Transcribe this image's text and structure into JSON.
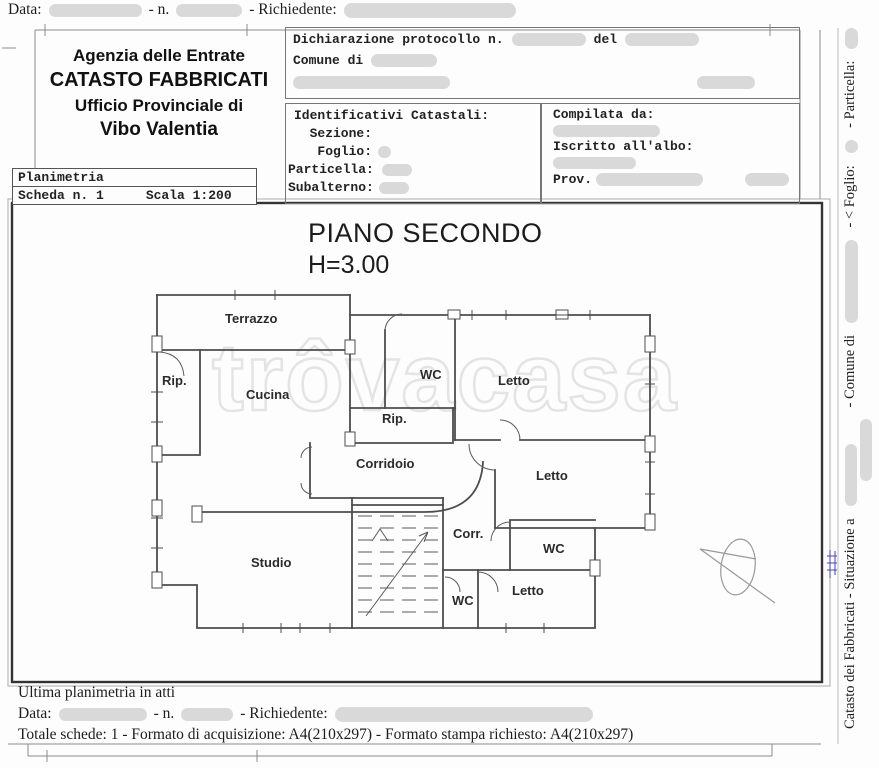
{
  "topline": {
    "data_label": "Data:",
    "n_label": "- n.",
    "richiedente_label": "- Richiedente:"
  },
  "agency": {
    "line1": "Agenzia delle Entrate",
    "line2": "CATASTO FABBRICATI",
    "line3": "Ufficio Provinciale di",
    "line4": "Vibo Valentia"
  },
  "declaration": {
    "protocol_label": "Dichiarazione protocollo n.",
    "del_label": "del",
    "comune_label": "Comune di"
  },
  "identificativi": {
    "title": "Identificativi Catastali:",
    "sezione": "  Sezione:",
    "foglio": "   Foglio:",
    "particella": "Particella:",
    "subalterno": "Subalterno:"
  },
  "compilata": {
    "title": "Compilata da:",
    "iscritto": "Iscritto all'albo:",
    "prov": "Prov."
  },
  "planimetria": {
    "title": "Planimetria",
    "scheda": "Scheda n. 1",
    "scala": "Scala 1:200"
  },
  "plan": {
    "title": "PIANO SECONDO",
    "height_label": "H=3.00",
    "watermark": "trôvacasa",
    "rooms": [
      {
        "label": "Terrazzo"
      },
      {
        "label": "Rip."
      },
      {
        "label": "Cucina"
      },
      {
        "label": "WC"
      },
      {
        "label": "Letto"
      },
      {
        "label": "Rip."
      },
      {
        "label": "Corridoio"
      },
      {
        "label": "Letto"
      },
      {
        "label": "Corr."
      },
      {
        "label": "WC"
      },
      {
        "label": "Studio"
      },
      {
        "label": "WC"
      },
      {
        "label": "Letto"
      }
    ]
  },
  "side_strip": {
    "part1": "Catasto dei Fabbricati - Situazione a",
    "part2": "- Comune di",
    "part3": "- < Foglio:",
    "part4": "- Particella:"
  },
  "footer": {
    "ultima": "Ultima planimetria in atti",
    "data_label": "Data:",
    "n_label": "- n.",
    "richiedente_label": "- Richiedente:",
    "totale": "Totale schede: 1 - Formato di acquisizione: A4(210x297)  - Formato stampa richiesto: A4(210x297)"
  },
  "colors": {
    "redaction": "#d9d9d9",
    "wall": "#4d4d4d",
    "watermark_stroke": "#e4e4e4",
    "annotation_blue": "#4444bb"
  }
}
